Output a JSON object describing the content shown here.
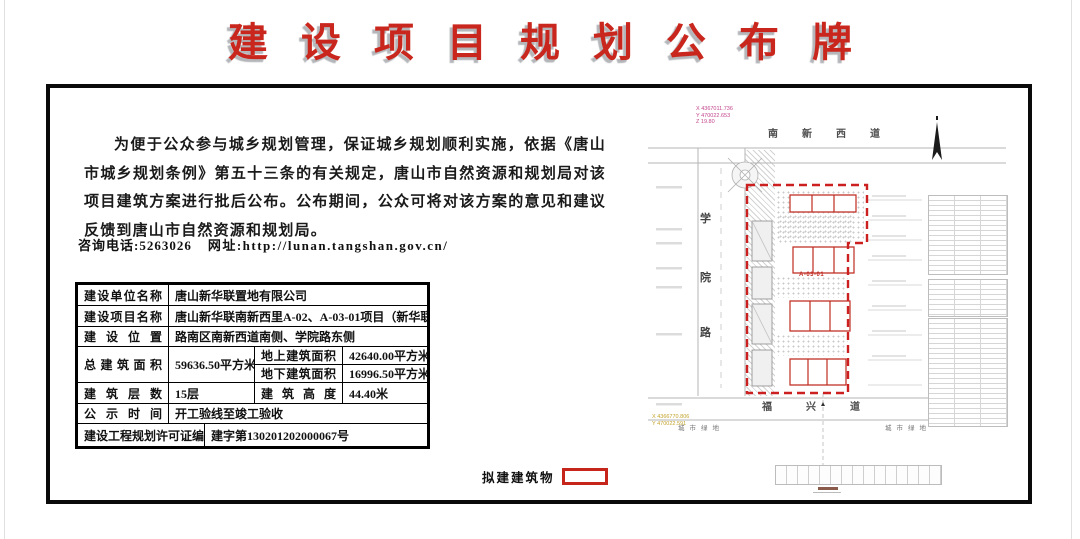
{
  "title": "建设项目规划公布牌",
  "notice": {
    "paragraph": "为便于公众参与城乡规划管理，保证城乡规划顺利实施，依据《唐山市城乡规划条例》第五十三条的有关规定，唐山市自然资源和规划局对该项目建筑方案进行批后公布。公布期间，公众可将对该方案的意见和建议反馈到唐山市自然资源和规划局。",
    "phone": "咨询电话:5263026",
    "website": "网址:http://lunan.tangshan.gov.cn/"
  },
  "table": {
    "rows": [
      {
        "label": "建设单位名称",
        "value": "唐山新华联置地有限公司"
      },
      {
        "label": "建设项目名称",
        "value": "唐山新华联南新西里A-02、A-03-01项目（新华联国花园A地块）"
      },
      {
        "label": "建设位置",
        "value": "路南区南新西道南侧、学院路东侧"
      },
      {
        "label": "总建筑面积",
        "value": "59636.50平方米",
        "sub": [
          {
            "label": "地上建筑面积",
            "value": "42640.00平方米"
          },
          {
            "label": "地下建筑面积",
            "value": "16996.50平方米"
          }
        ]
      },
      {
        "label": "建筑层数",
        "value": "15层",
        "label2": "建筑高度",
        "value2": "44.40米"
      },
      {
        "label": "公示时间",
        "value": "开工验线至竣工验收"
      },
      {
        "label": "建设工程规划许可证编号",
        "value": "建字第130201202000067号"
      }
    ]
  },
  "legend": {
    "label": "拟建建筑物"
  },
  "map": {
    "north_road": "南新西道",
    "south_road": "福兴道",
    "west_road_chars": [
      "学",
      "院",
      "路"
    ],
    "site_label": "A-03-01",
    "green_left": "城市绿地",
    "green_right": "城市绿地",
    "coord_top": [
      "X 4367011.736",
      "Y 470022.653",
      "Z 19.80"
    ],
    "coord_bottom": [
      "X 4366770.806",
      "Y 470022.591"
    ]
  }
}
